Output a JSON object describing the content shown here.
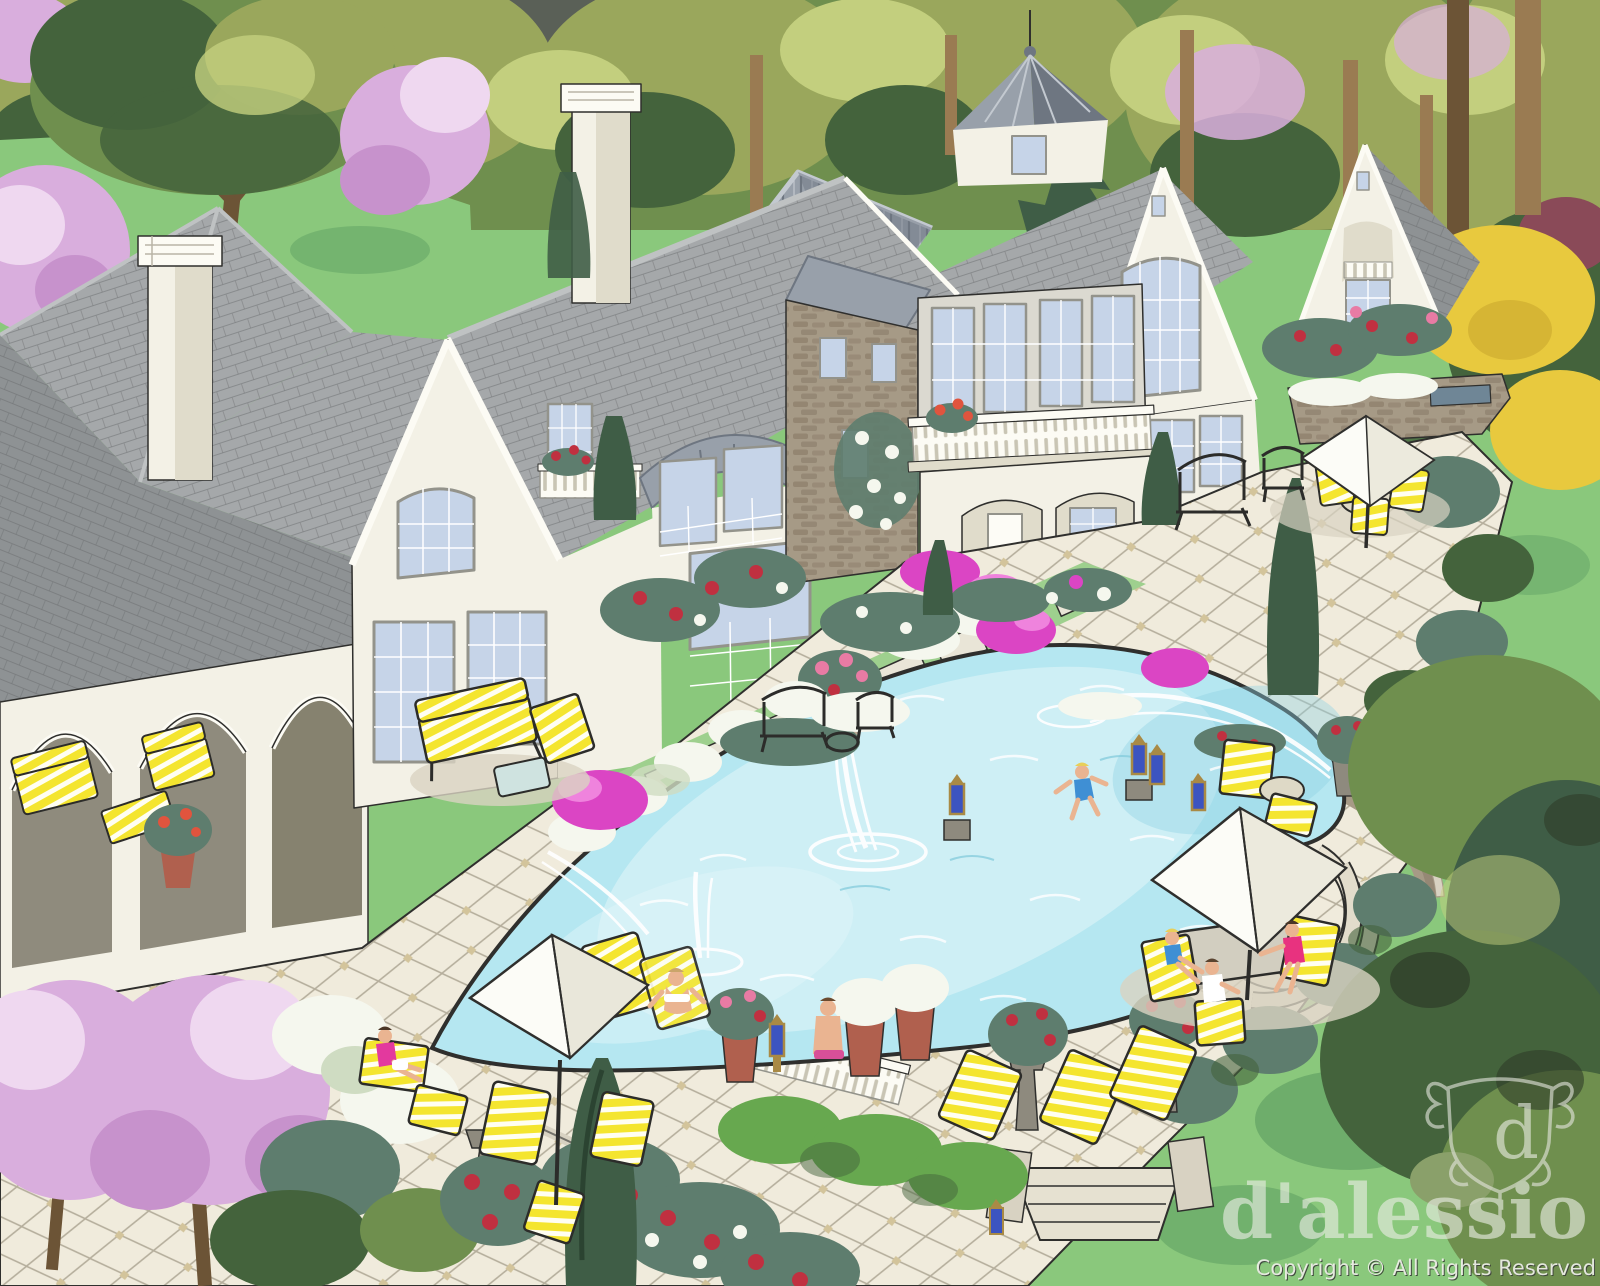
{
  "scene": {
    "type": "hand-colored architectural rendering",
    "subject": "Aerial rear view of a French country stone-and-stucco estate with gray shingle roofs, cupola, arched loggia, terraced patios, free-form pool with fountains, yellow-striped lounge furniture, white market umbrellas, flowering gardens and lawns",
    "watermark": {
      "monogram": "d",
      "brand": "d'alessio",
      "copyright": "Copyright © All Rights Reserved"
    },
    "palette": {
      "lawn": "#8ac87c",
      "lawn_dark": "#66a667",
      "lawn_bright": "#9ed08e",
      "foliage_dark": "#44633c",
      "foliage_mid": "#6f8f4e",
      "foliage_olive": "#9aa75c",
      "foliage_light": "#c3cf7e",
      "foliage_teal": "#5e7d6e",
      "conifer": "#3f5d46",
      "boxwood": "#67a84f",
      "blossom": "#d9aedd",
      "blossom_light": "#efd8f0",
      "magenta": "#db45c4",
      "rose_red": "#c03040",
      "flower_white": "#f5f7ee",
      "shrub_yellow": "#e8c93e",
      "trunk": "#9a7b52",
      "trunk_dark": "#6c5436",
      "roof_light": "#bfc2c3",
      "roof_mid": "#a5a8aa",
      "roof_dark": "#8e9294",
      "roof_line": "#707375",
      "metal_light": "#c3c9d0",
      "metal_mid": "#98a0aa",
      "metal_dark": "#6e7681",
      "wall": "#f3f1e6",
      "wall_shade": "#e0dccb",
      "wall_gray": "#dbd9d0",
      "trim": "#fcfbf4",
      "stone": "#a69a86",
      "stone_dark": "#847663",
      "glass": "#c6d4e8",
      "glass_light": "#e4ebf5",
      "frame": "#93938b",
      "patio": "#f0ebdc",
      "patio_line": "#b5ae9c",
      "patio_accent": "#d3c49b",
      "patio_shadow": "#d9d3c2",
      "pool": "#b5e7f1",
      "pool_light": "#dff5f9",
      "pool_deep": "#8ed2e3",
      "ink": "#2f2f2d",
      "furn_yellow": "#f4e52f",
      "furn_white": "#fffef2",
      "lantern_blue": "#3c54c0",
      "brass": "#a98a45",
      "skin": "#eab491",
      "iron": "#2c2c2a",
      "wm_light": "#eceee6"
    }
  }
}
